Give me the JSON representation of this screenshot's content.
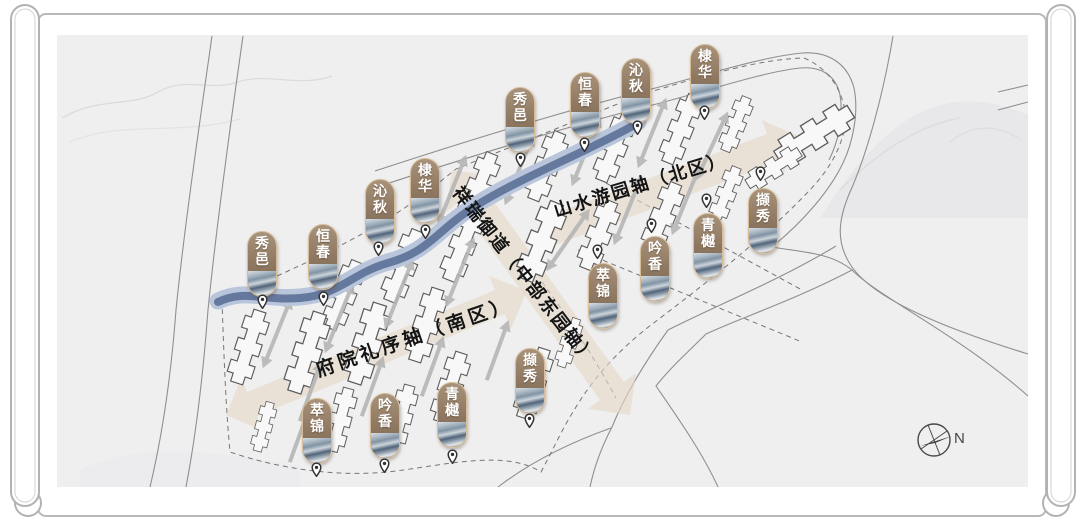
{
  "map": {
    "axes": {
      "north": "山水游园轴（北区）",
      "central": "祥瑞御道（中部东园轴）",
      "south": "府院礼序轴（南区）"
    },
    "compass_label": "N",
    "colors": {
      "axis_band": "#e5d8c6",
      "river_dark": "#65799e",
      "river_light": "#b9c5da",
      "marker_brown": "#8f7962",
      "marker_border": "#d6bd98",
      "arrow_gray": "#b5b5b5",
      "map_background": "#efeff0"
    },
    "markers": [
      {
        "id": "xiuyi-north",
        "label": "秀邑",
        "x": 505,
        "y": 87,
        "pin_x": 515,
        "pin_y": 152
      },
      {
        "id": "hengchun-north",
        "label": "恒春",
        "x": 570,
        "y": 72,
        "pin_x": 579,
        "pin_y": 137
      },
      {
        "id": "qinqiu-north",
        "label": "沁秋",
        "x": 621,
        "y": 58,
        "pin_x": 632,
        "pin_y": 120
      },
      {
        "id": "dihua-north",
        "label": "棣华",
        "x": 690,
        "y": 44,
        "pin_x": 699,
        "pin_y": 105
      },
      {
        "id": "xiuyi-west",
        "label": "秀邑",
        "x": 247,
        "y": 231,
        "pin_x": 257,
        "pin_y": 294
      },
      {
        "id": "hengchun-west",
        "label": "恒春",
        "x": 308,
        "y": 224,
        "pin_x": 318,
        "pin_y": 291
      },
      {
        "id": "qinqiu-west",
        "label": "沁秋",
        "x": 365,
        "y": 179,
        "pin_x": 373,
        "pin_y": 241
      },
      {
        "id": "dihua-west",
        "label": "棣华",
        "x": 410,
        "y": 158,
        "pin_x": 420,
        "pin_y": 224
      },
      {
        "id": "cuijin-south",
        "label": "萃锦",
        "x": 302,
        "y": 398,
        "pin_x": 311,
        "pin_y": 462
      },
      {
        "id": "yinxiang-south",
        "label": "吟香",
        "x": 370,
        "y": 393,
        "pin_x": 379,
        "pin_y": 458
      },
      {
        "id": "qingyue-south",
        "label": "青樾",
        "x": 437,
        "y": 382,
        "pin_x": 447,
        "pin_y": 449
      },
      {
        "id": "xiexiu-south",
        "label": "撷秀",
        "x": 515,
        "y": 348,
        "pin_x": 524,
        "pin_y": 413
      },
      {
        "id": "cuijin-east",
        "label": "萃锦",
        "x": 588,
        "y": 263,
        "pin_x": 592,
        "pin_y": 244
      },
      {
        "id": "yinxiang-east",
        "label": "吟香",
        "x": 640,
        "y": 236,
        "pin_x": 646,
        "pin_y": 218
      },
      {
        "id": "qingyue-east",
        "label": "青樾",
        "x": 693,
        "y": 213,
        "pin_x": 701,
        "pin_y": 193
      },
      {
        "id": "xiexiu-east",
        "label": "撷秀",
        "x": 748,
        "y": 188,
        "pin_x": 755,
        "pin_y": 166
      }
    ]
  }
}
